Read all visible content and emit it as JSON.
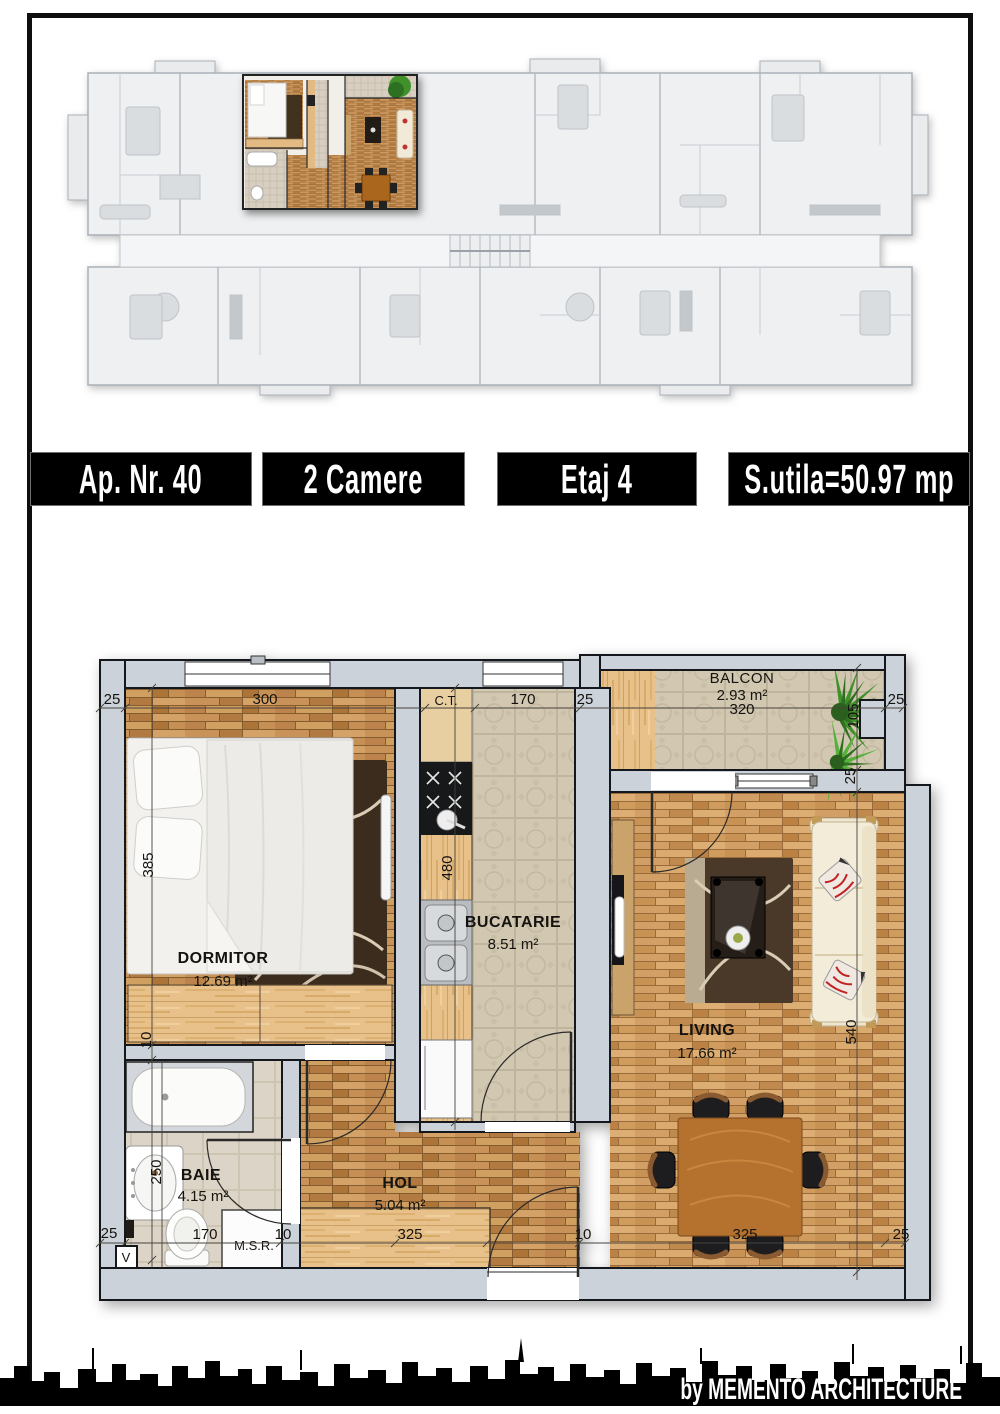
{
  "banner": {
    "apartment": "Ap. Nr. 40",
    "rooms": "2 Camere",
    "floor": "Etaj 4",
    "area": "S.utila=50.97 mp"
  },
  "plan": {
    "dormitor": {
      "name": "DORMITOR",
      "area": "12.69 m²"
    },
    "bucatarie": {
      "name": "BUCATARIE",
      "area": "8.51 m²"
    },
    "living": {
      "name": "LIVING",
      "area": "17.66 m²"
    },
    "baie": {
      "name": "BAIE",
      "area": "4.15 m²"
    },
    "hol": {
      "name": "HOL",
      "area": "5.04 m²"
    },
    "balcon": {
      "name": "BALCON",
      "area": "2.93 m²",
      "width": "320"
    },
    "labels": {
      "ct": "C.T.",
      "msr": "M.S.R.",
      "v": "V"
    },
    "dims": {
      "top_left": "25",
      "bedroom_width": "300",
      "kitchen_width": "170",
      "top_mid": "25",
      "top_right": "25",
      "balcony_depth": "105",
      "balcony_side": "25",
      "bedroom_height": "385",
      "wall": "10",
      "bath_height": "250",
      "kitchen_height": "480",
      "living_height": "540",
      "bottom_left": "25",
      "bath_width": "170",
      "wall_b": "10",
      "hol_width": "325",
      "wall_c": "10",
      "living_width": "325",
      "bottom_right": "25"
    }
  },
  "footer": {
    "credit": "by MEMENTO ARCHITECTURE"
  },
  "colors": {
    "banner_bg": "#000000",
    "banner_text": "#ffffff",
    "wall_fill": "#ccd2d9",
    "wall_outline": "#14181d",
    "parquet": "#c28a4e",
    "tile": "#d5cbb6",
    "wood_light": "#e7c08a",
    "plant_green": "#3f9129",
    "skyline": "#000000"
  }
}
